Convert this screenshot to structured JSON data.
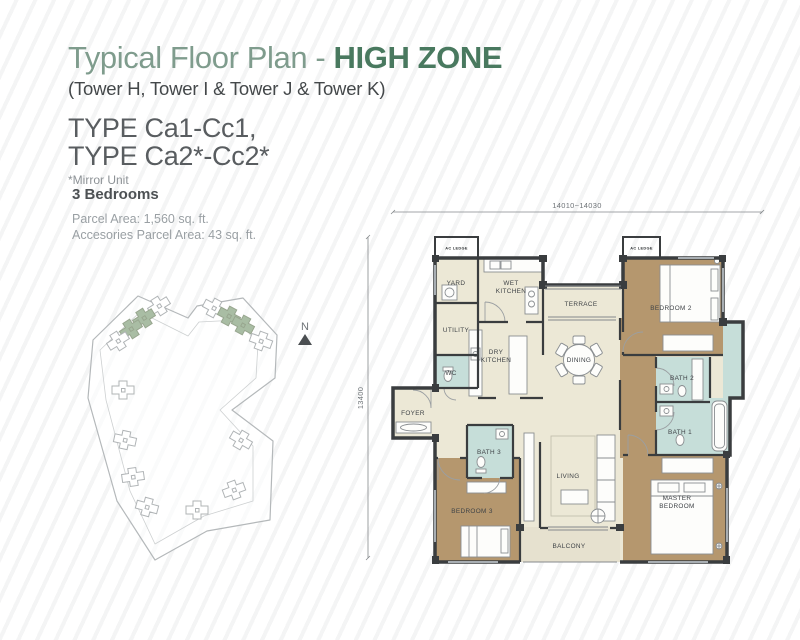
{
  "header": {
    "title_regular": "Typical Floor Plan - ",
    "title_bold": "HIGH ZONE",
    "towers": "(Tower H, Tower I & Tower J & Tower K)",
    "type_line1": "TYPE Ca1-Cc1,",
    "type_line2": "TYPE Ca2*-Cc2*",
    "mirror_note": "*Mirror Unit"
  },
  "details": {
    "bedrooms": "3 Bedrooms",
    "parcel_area": "Parcel Area: 1,560 sq. ft.",
    "accessories_area": "Accesories Parcel Area: 43 sq. ft."
  },
  "site_plan": {
    "north_label": "N",
    "highlight_color": "#a9bda4"
  },
  "plan": {
    "dim_top": "14010~14030",
    "dim_left": "13400",
    "ac_ledge_label": "AC LEDGE",
    "colors": {
      "floor_cream": "#ece8d6",
      "bedroom_tan": "#b5976e",
      "bath_teal": "#c6ded9",
      "balcony": "#e6e1cf",
      "wall": "#3a3d3f",
      "ledge_gray": "#99a0a8",
      "title_green": "#7f9c8d",
      "accent_green": "#49795f"
    },
    "room_labels": [
      {
        "id": "yard",
        "lines": [
          "YARD"
        ],
        "x": 108,
        "y": 95
      },
      {
        "id": "wet-kitchen",
        "lines": [
          "WET",
          "KITCHEN"
        ],
        "x": 163,
        "y": 99
      },
      {
        "id": "terrace",
        "lines": [
          "TERRACE"
        ],
        "x": 233,
        "y": 116
      },
      {
        "id": "bedroom-2",
        "lines": [
          "BEDROOM 2"
        ],
        "x": 323,
        "y": 120
      },
      {
        "id": "utility",
        "lines": [
          "UTILITY"
        ],
        "x": 108,
        "y": 142
      },
      {
        "id": "wc",
        "lines": [
          "WC"
        ],
        "x": 103,
        "y": 185
      },
      {
        "id": "dry-kitchen",
        "lines": [
          "DRY",
          "KITCHEN"
        ],
        "x": 148,
        "y": 168
      },
      {
        "id": "dining",
        "lines": [
          "DINING"
        ],
        "x": 231,
        "y": 172
      },
      {
        "id": "bath-2",
        "lines": [
          "BATH 2"
        ],
        "x": 334,
        "y": 190
      },
      {
        "id": "bath-1",
        "lines": [
          "BATH 1"
        ],
        "x": 332,
        "y": 244
      },
      {
        "id": "foyer",
        "lines": [
          "FOYER"
        ],
        "x": 65,
        "y": 225
      },
      {
        "id": "bath-3",
        "lines": [
          "BATH 3"
        ],
        "x": 141,
        "y": 264
      },
      {
        "id": "living",
        "lines": [
          "LIVING"
        ],
        "x": 220,
        "y": 288
      },
      {
        "id": "bedroom-3",
        "lines": [
          "BEDROOM 3"
        ],
        "x": 124,
        "y": 323
      },
      {
        "id": "master-bedroom",
        "lines": [
          "MASTER",
          "BEDROOM"
        ],
        "x": 329,
        "y": 314
      },
      {
        "id": "balcony",
        "lines": [
          "BALCONY"
        ],
        "x": 221,
        "y": 358
      }
    ]
  }
}
